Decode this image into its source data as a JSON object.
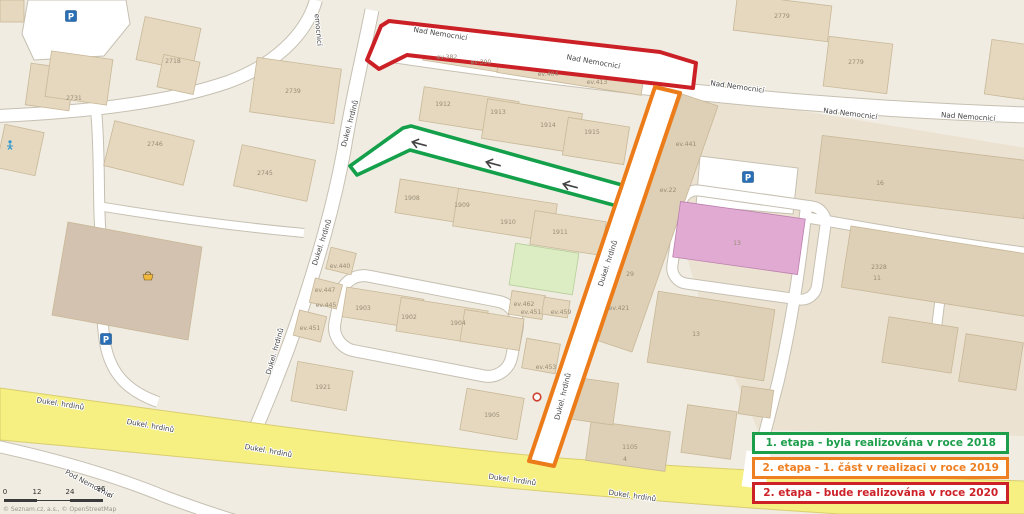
{
  "legend": {
    "items": [
      {
        "label": "1. etapa - byla realizována v roce 2018",
        "color": "#1d9e4b"
      },
      {
        "label": "2. etapa - 1. část v realizaci v roce 2019",
        "color": "#ee7f22"
      },
      {
        "label": "2. etapa - bude realizována v roce 2020",
        "color": "#cc2127"
      }
    ]
  },
  "scale_bar": {
    "ticks": [
      "0",
      "12",
      "24",
      "36"
    ],
    "unit": "m"
  },
  "attribution": "© Seznam.cz, a.s., © OpenStreetMap",
  "map": {
    "route_colors": {
      "red": "#cb2026",
      "green": "#14a04a",
      "orange": "#ec7c19",
      "road_yellow": "#f6ef82"
    },
    "street_labels": [
      {
        "text": "Nad Nemocnicí",
        "x": 440,
        "y": 36,
        "rot": 9
      },
      {
        "text": "Nad Nemocnicí",
        "x": 593,
        "y": 64,
        "rot": 10
      },
      {
        "text": "Nad Nemocnicí",
        "x": 737,
        "y": 89,
        "rot": 8
      },
      {
        "text": "Nad Nemocnicí",
        "x": 850,
        "y": 116,
        "rot": 7
      },
      {
        "text": "Nad Nemocnicí",
        "x": 968,
        "y": 119,
        "rot": 4
      },
      {
        "text": "emocnicí",
        "x": 316,
        "y": 30,
        "rot": 85
      },
      {
        "text": "Dukel. hrdinů",
        "x": 352,
        "y": 124,
        "rot": -75
      },
      {
        "text": "Dukel. hrdinů",
        "x": 324,
        "y": 243,
        "rot": -72
      },
      {
        "text": "Dukel. hrdinů",
        "x": 277,
        "y": 352,
        "rot": -74
      },
      {
        "text": "Dukel. hrdinů",
        "x": 610,
        "y": 264,
        "rot": -72
      },
      {
        "text": "Dukel. hrdinů",
        "x": 565,
        "y": 397,
        "rot": -76
      },
      {
        "text": "Dukel. hrdinů",
        "x": 60,
        "y": 406,
        "rot": 9
      },
      {
        "text": "Dukel. hrdinů",
        "x": 150,
        "y": 428,
        "rot": 10
      },
      {
        "text": "Dukel. hrdinů",
        "x": 268,
        "y": 453,
        "rot": 10
      },
      {
        "text": "Dukel. hrdinů",
        "x": 512,
        "y": 482,
        "rot": 8
      },
      {
        "text": "Dukel. hrdinů",
        "x": 632,
        "y": 498,
        "rot": 8
      },
      {
        "text": "Pod Nemocnicí",
        "x": 88,
        "y": 486,
        "rot": 28
      }
    ],
    "building_labels": [
      {
        "text": "2779",
        "x": 782,
        "y": 18
      },
      {
        "text": "2779",
        "x": 856,
        "y": 64
      },
      {
        "text": "2718",
        "x": 173,
        "y": 63
      },
      {
        "text": "2731",
        "x": 74,
        "y": 100
      },
      {
        "text": "2739",
        "x": 293,
        "y": 93
      },
      {
        "text": "2746",
        "x": 155,
        "y": 146
      },
      {
        "text": "2745",
        "x": 265,
        "y": 175
      },
      {
        "text": "ev.382",
        "x": 447,
        "y": 59
      },
      {
        "text": "ev.390",
        "x": 481,
        "y": 64
      },
      {
        "text": "ev.404",
        "x": 548,
        "y": 76
      },
      {
        "text": "ev.413",
        "x": 597,
        "y": 84
      },
      {
        "text": "1912",
        "x": 443,
        "y": 106
      },
      {
        "text": "1913",
        "x": 498,
        "y": 114
      },
      {
        "text": "1914",
        "x": 548,
        "y": 127
      },
      {
        "text": "1915",
        "x": 592,
        "y": 134
      },
      {
        "text": "1908",
        "x": 412,
        "y": 200
      },
      {
        "text": "1909",
        "x": 462,
        "y": 207
      },
      {
        "text": "1910",
        "x": 508,
        "y": 224
      },
      {
        "text": "1911",
        "x": 560,
        "y": 234
      },
      {
        "text": "ev.441",
        "x": 686,
        "y": 146
      },
      {
        "text": "ev.22",
        "x": 668,
        "y": 192
      },
      {
        "text": "16",
        "x": 880,
        "y": 185
      },
      {
        "text": "13",
        "x": 737,
        "y": 245
      },
      {
        "text": "2328",
        "x": 879,
        "y": 269
      },
      {
        "text": "11",
        "x": 877,
        "y": 280
      },
      {
        "text": "13",
        "x": 696,
        "y": 336
      },
      {
        "text": "ev.440",
        "x": 340,
        "y": 268
      },
      {
        "text": "ev.447",
        "x": 325,
        "y": 292
      },
      {
        "text": "ev.445",
        "x": 326,
        "y": 307
      },
      {
        "text": "ev.451",
        "x": 310,
        "y": 330
      },
      {
        "text": "1903",
        "x": 363,
        "y": 310
      },
      {
        "text": "1902",
        "x": 409,
        "y": 319
      },
      {
        "text": "1904",
        "x": 458,
        "y": 325
      },
      {
        "text": "1921",
        "x": 323,
        "y": 389
      },
      {
        "text": "1905",
        "x": 492,
        "y": 417
      },
      {
        "text": "ev.462",
        "x": 524,
        "y": 306
      },
      {
        "text": "ev.451",
        "x": 531,
        "y": 314
      },
      {
        "text": "ev.459",
        "x": 561,
        "y": 314
      },
      {
        "text": "ev.453",
        "x": 546,
        "y": 369
      },
      {
        "text": "ev.421",
        "x": 619,
        "y": 310
      },
      {
        "text": "29",
        "x": 630,
        "y": 276
      },
      {
        "text": "1105",
        "x": 630,
        "y": 449
      },
      {
        "text": "4",
        "x": 625,
        "y": 461
      }
    ],
    "one_way_arrows": [
      {
        "x": 420,
        "y": 144,
        "rot": 15
      },
      {
        "x": 494,
        "y": 164,
        "rot": 15
      },
      {
        "x": 571,
        "y": 186,
        "rot": 15
      }
    ],
    "icons": [
      {
        "name": "parking",
        "x": 71,
        "y": 16
      },
      {
        "name": "parking",
        "x": 748,
        "y": 177
      },
      {
        "name": "parking",
        "x": 106,
        "y": 339
      },
      {
        "name": "playground",
        "x": 10,
        "y": 145
      },
      {
        "name": "shop",
        "x": 148,
        "y": 276
      },
      {
        "name": "poi-red-circle",
        "x": 537,
        "y": 397
      }
    ]
  }
}
